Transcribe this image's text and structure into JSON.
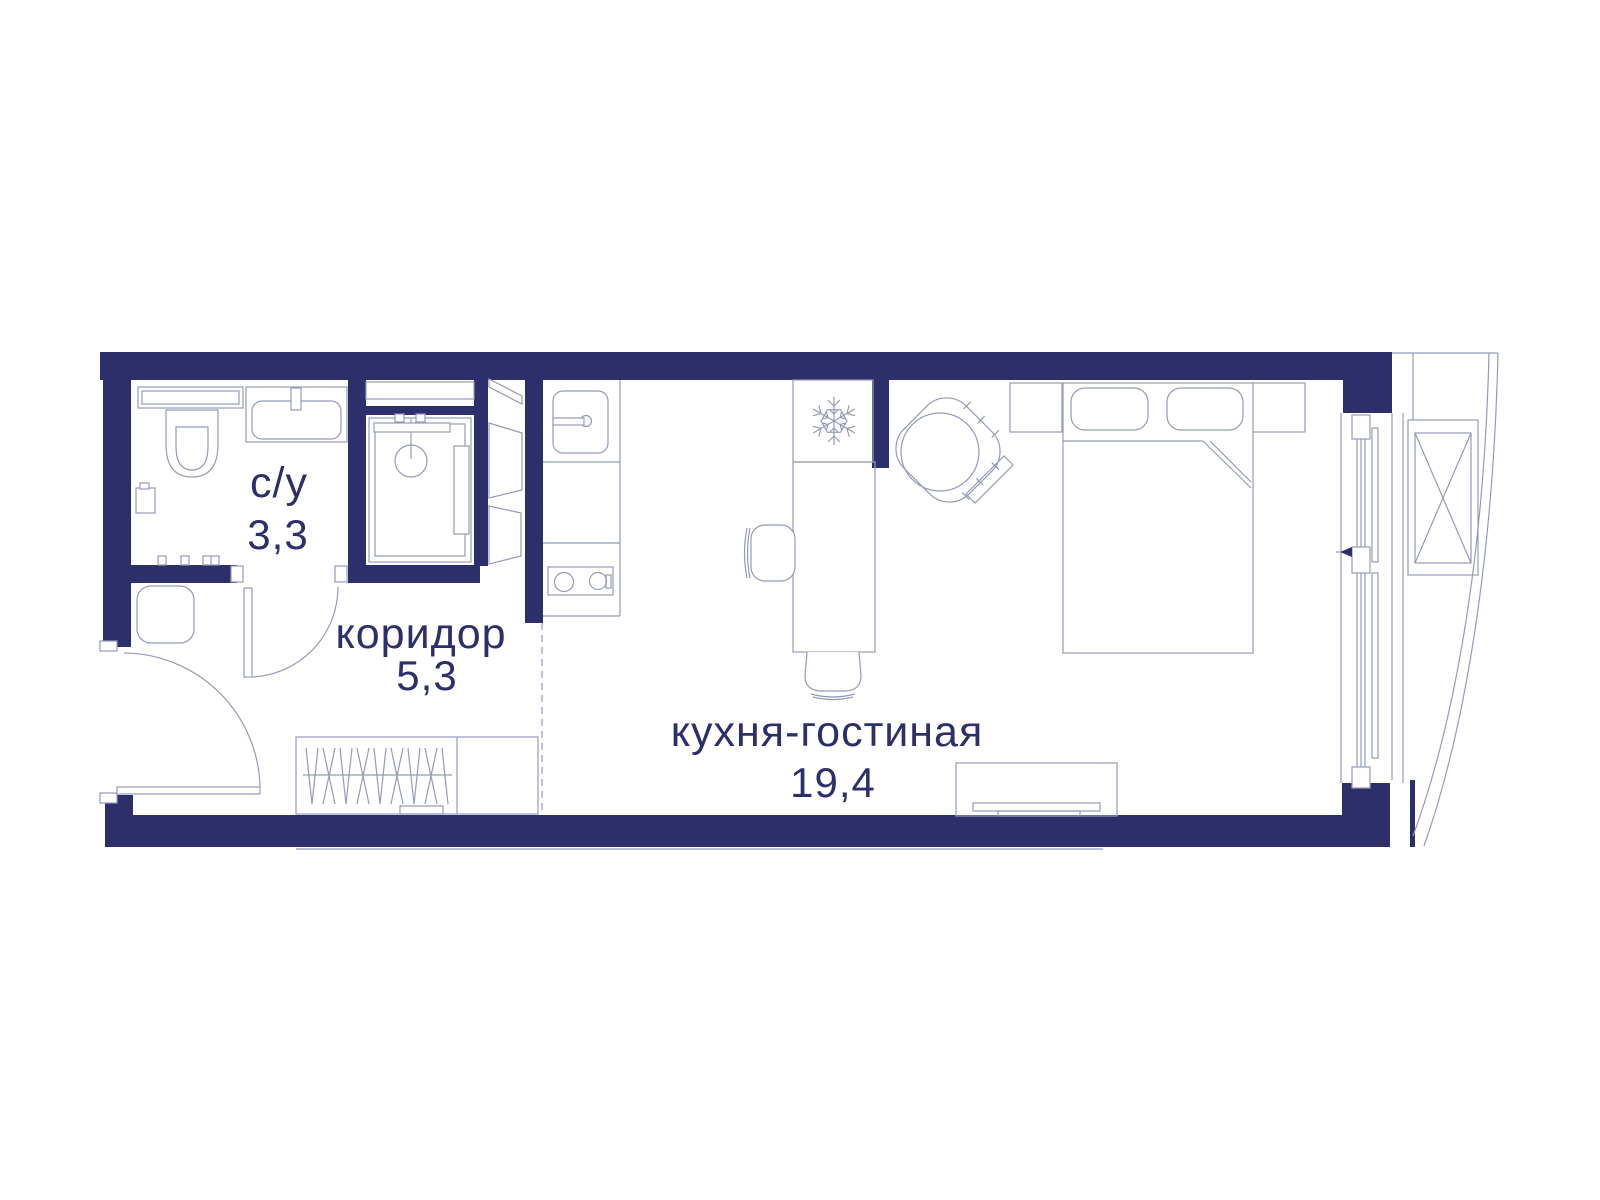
{
  "plan": {
    "type": "apartment-floor-plan",
    "rooms": [
      {
        "id": "bathroom",
        "label": "с/у",
        "area": "3,3"
      },
      {
        "id": "corridor",
        "label": "коридор",
        "area": "5,3"
      },
      {
        "id": "kitchen-living",
        "label": "кухня-гостиная",
        "area": "19,4"
      }
    ],
    "icons": {
      "fridge_icon": "snowflake"
    },
    "colors": {
      "wall": "#2d2f6a",
      "furniture_line": "#959ab9",
      "label_text": "#2d2f6a",
      "background": "#ffffff"
    }
  }
}
